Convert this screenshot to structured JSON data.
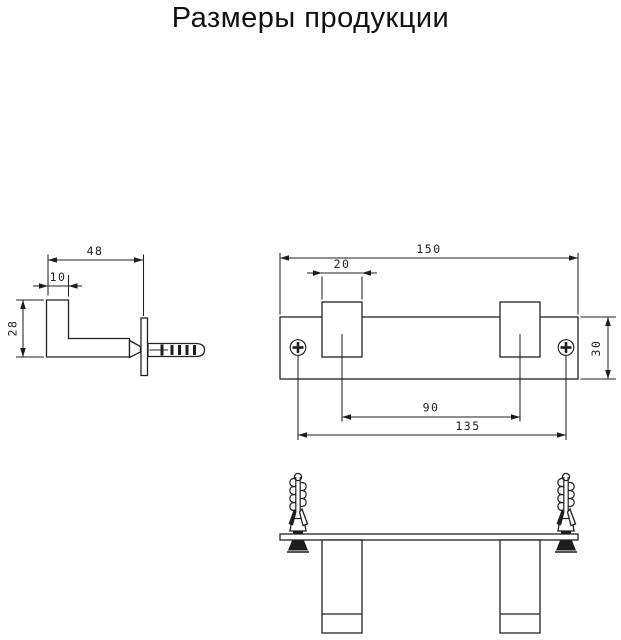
{
  "title": "Размеры продукции",
  "colors": {
    "line": "#222222",
    "text": "#222222",
    "background": "#ffffff"
  },
  "views": {
    "side": {
      "width": "48",
      "hook_offset": "10",
      "height": "28"
    },
    "front": {
      "total_width": "150",
      "hook_width": "20",
      "bar_height": "30",
      "hook_spacing": "90",
      "mount_hole_spacing": "135"
    }
  }
}
